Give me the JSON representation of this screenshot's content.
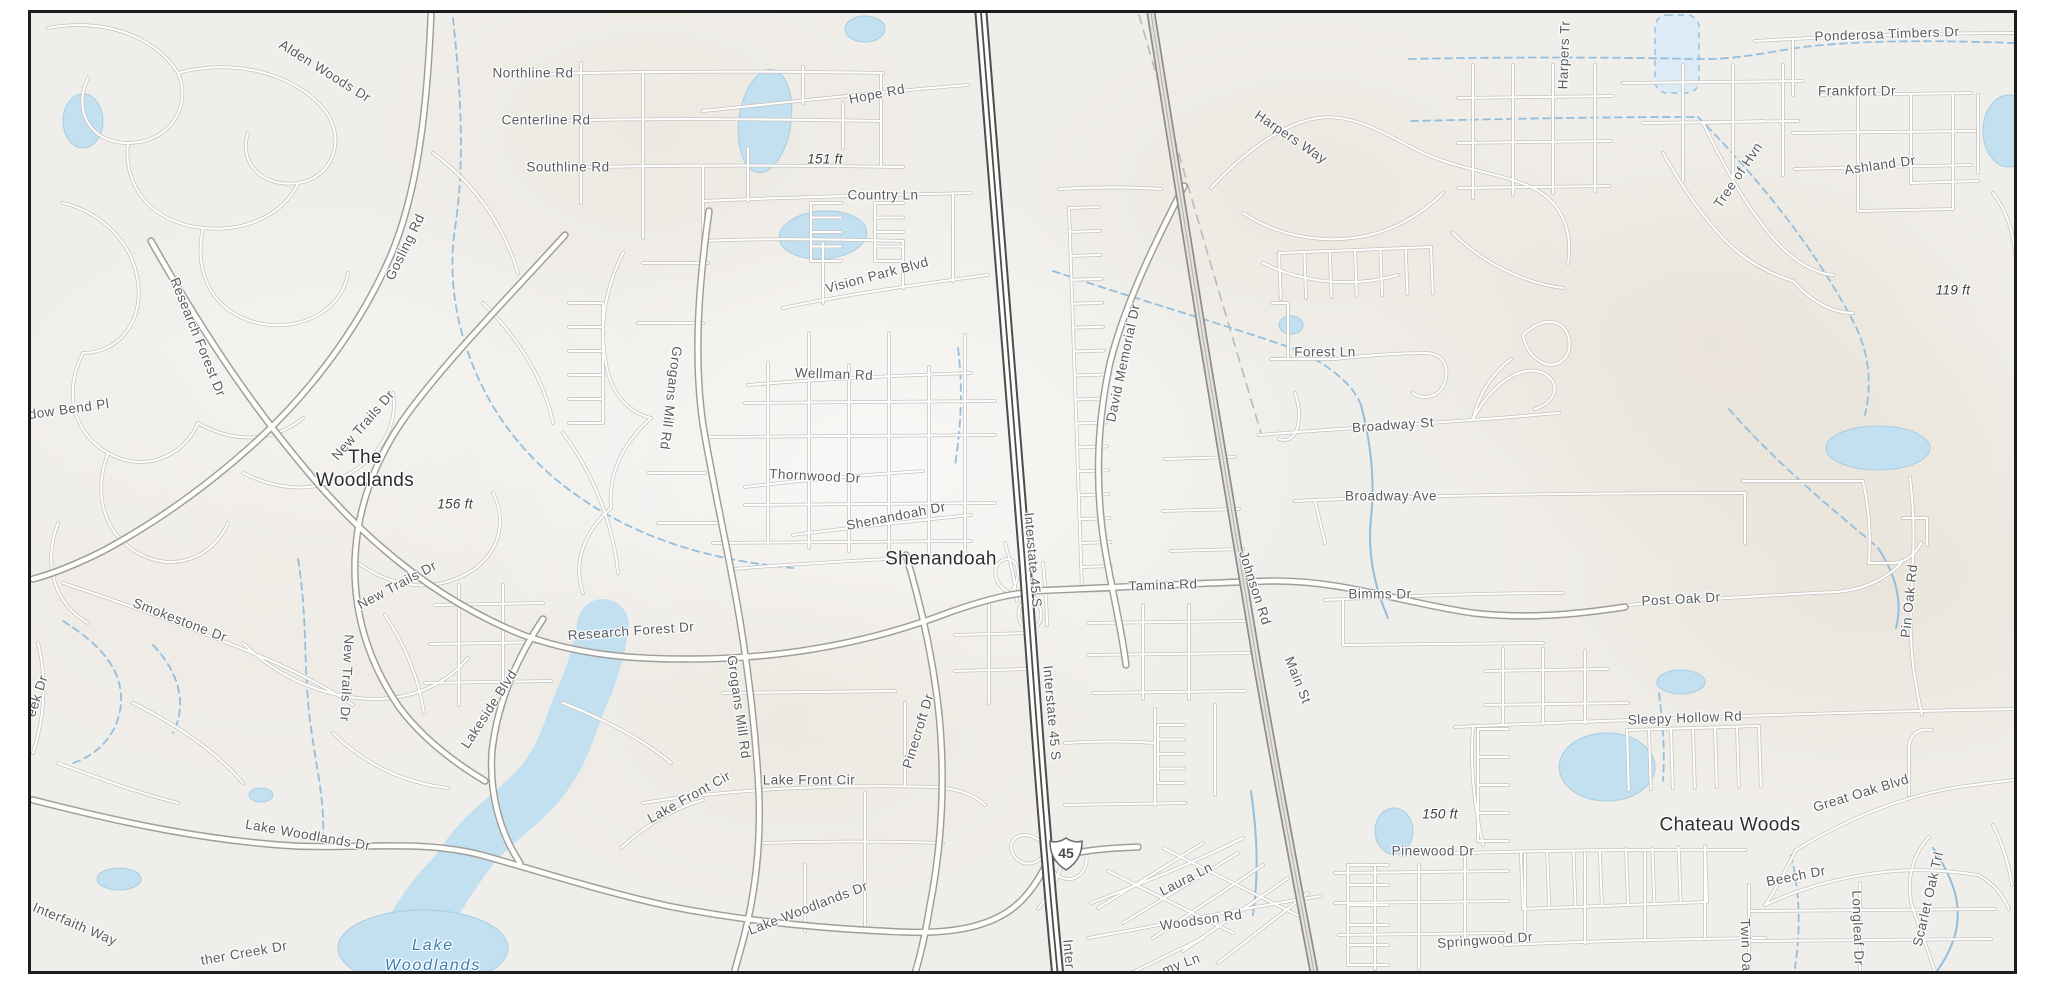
{
  "map": {
    "region": "street map of The Woodlands / Shenandoah / Chateau Woods area with Interstate 45",
    "colors": {
      "background": "#f0eeea",
      "border": "#1d1d1d",
      "water_fill": "#c2e0f0",
      "water_line": "#93bedd",
      "road_fill": "#ffffff",
      "road_casing": "#c6c3bf",
      "highway_casing": "#4d4d4d",
      "road_label": "#575c60",
      "place_label": "#2d2d2d",
      "water_label": "#3a7db2",
      "elevation_label": "#3c3d3f"
    },
    "shield": {
      "type": "interstate",
      "number": "45",
      "x": 1063,
      "y": 851
    },
    "labels": [
      {
        "text": "Alden Woods Dr",
        "x": 322,
        "y": 68,
        "rot": 32,
        "kind": "street"
      },
      {
        "text": "Northline Rd",
        "x": 530,
        "y": 70,
        "rot": 0,
        "kind": "street"
      },
      {
        "text": "Centerline Rd",
        "x": 543,
        "y": 117,
        "rot": 0,
        "kind": "street"
      },
      {
        "text": "Southline Rd",
        "x": 565,
        "y": 164,
        "rot": 0,
        "kind": "street"
      },
      {
        "text": "Hope Rd",
        "x": 874,
        "y": 91,
        "rot": -11,
        "kind": "street"
      },
      {
        "text": "Country Ln",
        "x": 880,
        "y": 192,
        "rot": 0,
        "kind": "street"
      },
      {
        "text": "Vision Park Blvd",
        "x": 874,
        "y": 272,
        "rot": -15,
        "kind": "street"
      },
      {
        "text": "Gosling Rd",
        "x": 402,
        "y": 244,
        "rot": -64,
        "kind": "street"
      },
      {
        "text": "Research Forest Dr",
        "x": 195,
        "y": 334,
        "rot": 68,
        "kind": "street"
      },
      {
        "text": "dow Bend Pl",
        "x": 66,
        "y": 406,
        "rot": -8,
        "kind": "street"
      },
      {
        "text": "New Trails Dr",
        "x": 360,
        "y": 422,
        "rot": -49,
        "kind": "street"
      },
      {
        "text": "New Trails Dr",
        "x": 394,
        "y": 582,
        "rot": -28,
        "kind": "street"
      },
      {
        "text": "New Trails Dr",
        "x": 344,
        "y": 675,
        "rot": 93,
        "kind": "street"
      },
      {
        "text": "Smokestone Dr",
        "x": 177,
        "y": 617,
        "rot": 21,
        "kind": "street"
      },
      {
        "text": "eek Dr",
        "x": 34,
        "y": 693,
        "rot": -72,
        "kind": "street"
      },
      {
        "text": "Lakeside Blvd",
        "x": 486,
        "y": 706,
        "rot": -57,
        "kind": "street"
      },
      {
        "text": "Grogans Mill Rd",
        "x": 668,
        "y": 395,
        "rot": 97,
        "kind": "street"
      },
      {
        "text": "Grogans Mill Rd",
        "x": 736,
        "y": 704,
        "rot": 82,
        "kind": "street"
      },
      {
        "text": "Research Forest Dr",
        "x": 628,
        "y": 628,
        "rot": -4,
        "kind": "street"
      },
      {
        "text": "Lake Front Cir",
        "x": 686,
        "y": 794,
        "rot": -29,
        "kind": "street"
      },
      {
        "text": "Lake Front Cir",
        "x": 806,
        "y": 777,
        "rot": 0,
        "kind": "street"
      },
      {
        "text": "Pinecroft Dr",
        "x": 915,
        "y": 728,
        "rot": -73,
        "kind": "street"
      },
      {
        "text": "Lake Woodlands Dr",
        "x": 305,
        "y": 832,
        "rot": 10,
        "kind": "street"
      },
      {
        "text": "Lake Woodlands Dr",
        "x": 805,
        "y": 905,
        "rot": -21,
        "kind": "street"
      },
      {
        "text": "Interfaith Way",
        "x": 72,
        "y": 921,
        "rot": 23,
        "kind": "street"
      },
      {
        "text": "ther Creek Dr",
        "x": 241,
        "y": 950,
        "rot": -10,
        "kind": "street"
      },
      {
        "text": "Interstate 45 S",
        "x": 1030,
        "y": 557,
        "rot": 85,
        "kind": "street"
      },
      {
        "text": "Interstate 45 S",
        "x": 1049,
        "y": 710,
        "rot": 85,
        "kind": "street"
      },
      {
        "text": "Inter",
        "x": 1066,
        "y": 951,
        "rot": 85,
        "kind": "street"
      },
      {
        "text": "David Memorial Dr",
        "x": 1120,
        "y": 360,
        "rot": -78,
        "kind": "street"
      },
      {
        "text": "Tamina Rd",
        "x": 1160,
        "y": 582,
        "rot": -2,
        "kind": "street"
      },
      {
        "text": "Johnson Rd",
        "x": 1252,
        "y": 585,
        "rot": 72,
        "kind": "street"
      },
      {
        "text": "Main St",
        "x": 1295,
        "y": 677,
        "rot": 68,
        "kind": "street"
      },
      {
        "text": "Harpers Way",
        "x": 1288,
        "y": 134,
        "rot": 34,
        "kind": "street"
      },
      {
        "text": "Harpers Tr",
        "x": 1561,
        "y": 52,
        "rot": -88,
        "kind": "street"
      },
      {
        "text": "Forest Ln",
        "x": 1322,
        "y": 349,
        "rot": 0,
        "kind": "street"
      },
      {
        "text": "Broadway St",
        "x": 1390,
        "y": 422,
        "rot": -4,
        "kind": "street"
      },
      {
        "text": "Broadway Ave",
        "x": 1388,
        "y": 493,
        "rot": 0,
        "kind": "street"
      },
      {
        "text": "Bimms Dr",
        "x": 1377,
        "y": 591,
        "rot": 0,
        "kind": "street"
      },
      {
        "text": "Post Oak Dr",
        "x": 1678,
        "y": 596,
        "rot": -3,
        "kind": "street"
      },
      {
        "text": "Pin Oak Rd",
        "x": 1906,
        "y": 598,
        "rot": -84,
        "kind": "street"
      },
      {
        "text": "Sleepy Hollow Rd",
        "x": 1682,
        "y": 715,
        "rot": -2,
        "kind": "street"
      },
      {
        "text": "Great Oak Blvd",
        "x": 1858,
        "y": 790,
        "rot": -17,
        "kind": "street"
      },
      {
        "text": "Beech Dr",
        "x": 1793,
        "y": 873,
        "rot": -11,
        "kind": "street"
      },
      {
        "text": "Twin Oa",
        "x": 1743,
        "y": 942,
        "rot": 88,
        "kind": "street"
      },
      {
        "text": "Longleaf Dr",
        "x": 1855,
        "y": 925,
        "rot": 88,
        "kind": "street"
      },
      {
        "text": "Scarlet Oak Trl",
        "x": 1925,
        "y": 896,
        "rot": -77,
        "kind": "street"
      },
      {
        "text": "Springwood Dr",
        "x": 1482,
        "y": 937,
        "rot": -4,
        "kind": "street"
      },
      {
        "text": "Pinewood Dr",
        "x": 1430,
        "y": 848,
        "rot": 0,
        "kind": "street"
      },
      {
        "text": "Laura Ln",
        "x": 1183,
        "y": 876,
        "rot": -27,
        "kind": "street"
      },
      {
        "text": "Woodson Rd",
        "x": 1198,
        "y": 917,
        "rot": -8,
        "kind": "street"
      },
      {
        "text": "my Ln",
        "x": 1178,
        "y": 961,
        "rot": -20,
        "kind": "street"
      },
      {
        "text": "Ponderosa Timbers Dr",
        "x": 1884,
        "y": 31,
        "rot": -2,
        "kind": "street"
      },
      {
        "text": "Frankfort Dr",
        "x": 1854,
        "y": 88,
        "rot": 0,
        "kind": "street"
      },
      {
        "text": "Ashland Dr",
        "x": 1877,
        "y": 162,
        "rot": -8,
        "kind": "street"
      },
      {
        "text": "Tree of Hvn",
        "x": 1735,
        "y": 172,
        "rot": -56,
        "kind": "street"
      },
      {
        "text": "Wellman Rd",
        "x": 831,
        "y": 371,
        "rot": 2,
        "kind": "street"
      },
      {
        "text": "Thornwood Dr",
        "x": 812,
        "y": 473,
        "rot": 3,
        "kind": "street"
      },
      {
        "text": "Shenandoah Dr",
        "x": 893,
        "y": 513,
        "rot": -11,
        "kind": "street"
      },
      {
        "text": "The\nWoodlands",
        "x": 362,
        "y": 466,
        "rot": 0,
        "kind": "place"
      },
      {
        "text": "Shenandoah",
        "x": 938,
        "y": 556,
        "rot": 0,
        "kind": "place"
      },
      {
        "text": "Chateau Woods",
        "x": 1727,
        "y": 822,
        "rot": 0,
        "kind": "place"
      },
      {
        "text": "Lake\nWoodlands",
        "x": 430,
        "y": 953,
        "rot": 0,
        "kind": "water"
      },
      {
        "text": "151 ft",
        "x": 822,
        "y": 156,
        "rot": 0,
        "kind": "elevation"
      },
      {
        "text": "156 ft",
        "x": 452,
        "y": 501,
        "rot": 0,
        "kind": "elevation"
      },
      {
        "text": "150 ft",
        "x": 1437,
        "y": 811,
        "rot": 0,
        "kind": "elevation"
      },
      {
        "text": "119 ft",
        "x": 1950,
        "y": 287,
        "rot": 0,
        "kind": "elevation"
      }
    ]
  }
}
